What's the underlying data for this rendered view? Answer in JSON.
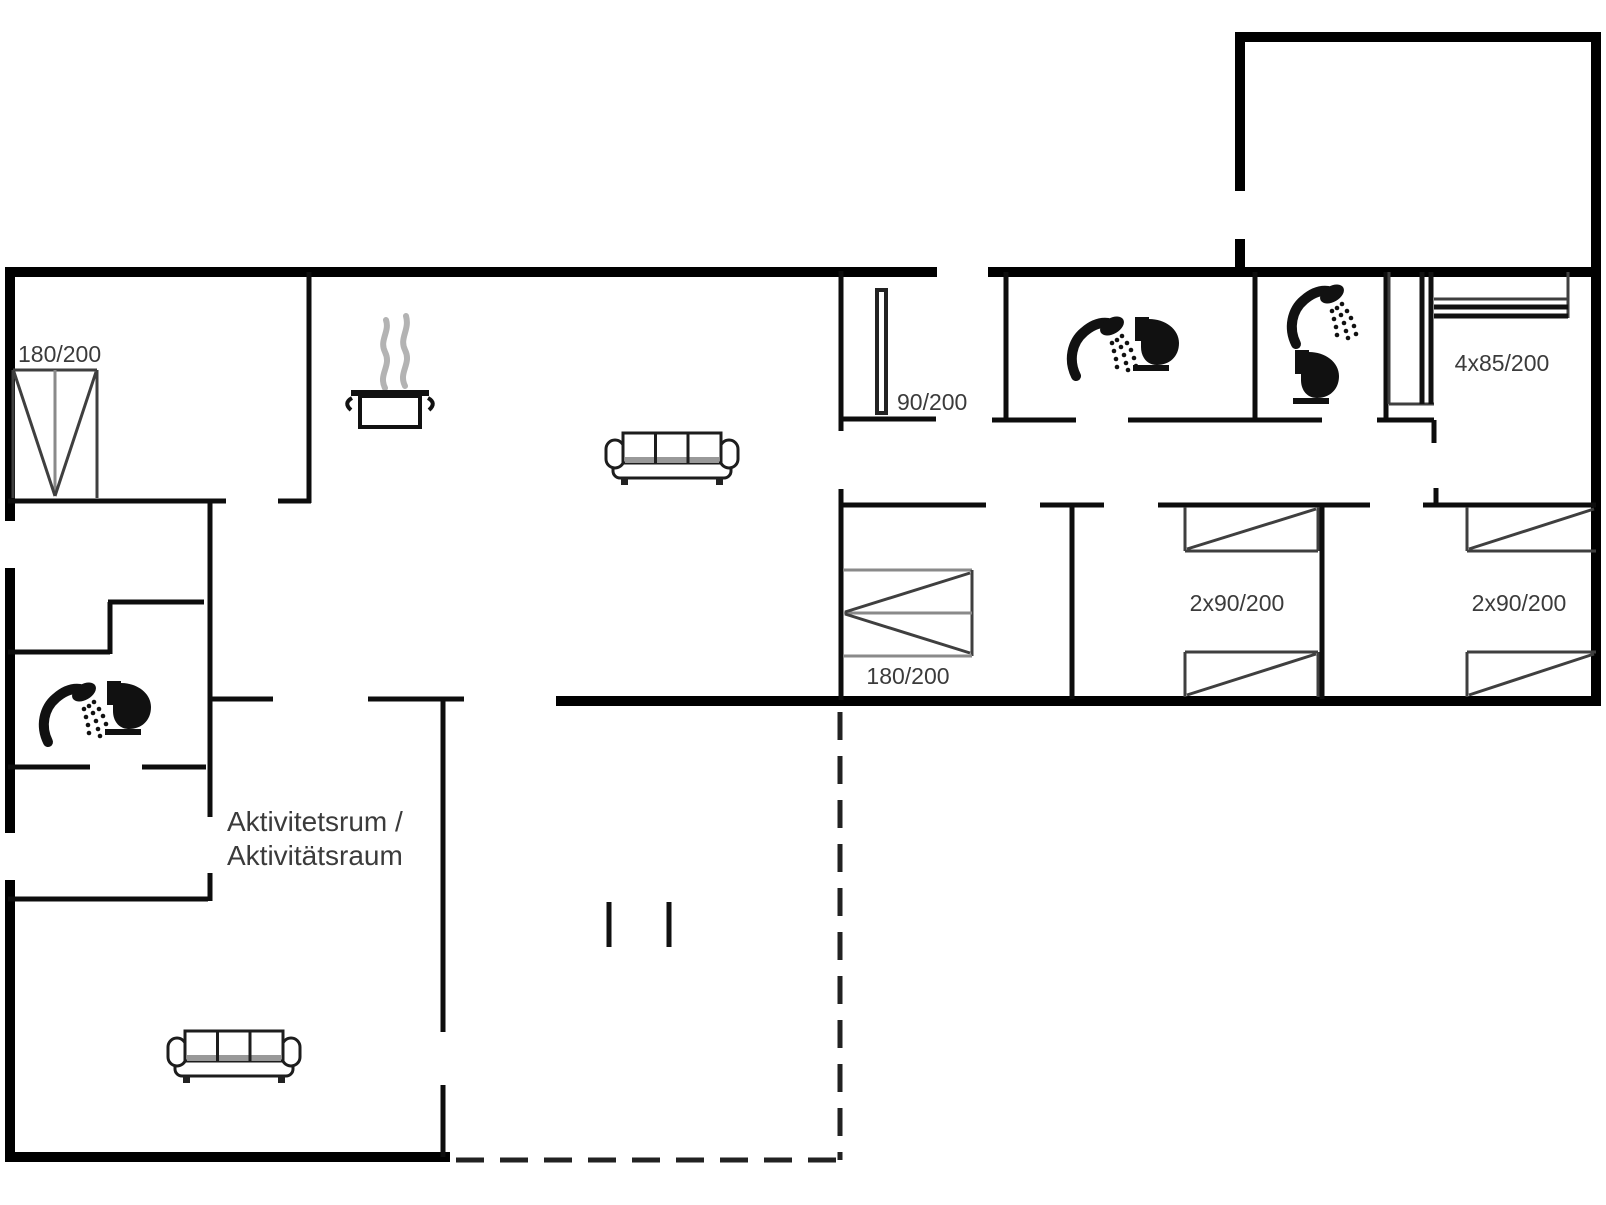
{
  "floorplan": {
    "type": "holiday-house-floor-plan",
    "background": "#ffffff",
    "wall_color": "#000000",
    "label_color": "#3b3b3b",
    "labels": {
      "bedroom1_bed": "180/200",
      "hall_closet": "90/200",
      "master_bed": "180/200",
      "kids_room_1_beds": "2x90/200",
      "kids_room_2_beds": "2x90/200",
      "bunk_room_beds": "4x85/200",
      "activity_room_line1": "Aktivitetsrum /",
      "activity_room_line2": "Aktivitätsraum"
    },
    "icons": {
      "cooking_pot": "cooking-pot-icon",
      "sofa_living": "sofa-icon",
      "sofa_activity": "sofa-icon",
      "shower_bath1": "shower-icon",
      "toilet_bath1": "toilet-icon",
      "shower_bath2": "shower-icon",
      "toilet_bath2": "toilet-icon",
      "shower_bath3": "shower-icon",
      "toilet_bath3": "toilet-icon",
      "double_bed": "double-bed-icon",
      "single_bed": "single-bed-icon",
      "bunk_bed": "bunk-bed-icon",
      "terrace_outline": "dashed-terrace-outline"
    }
  }
}
